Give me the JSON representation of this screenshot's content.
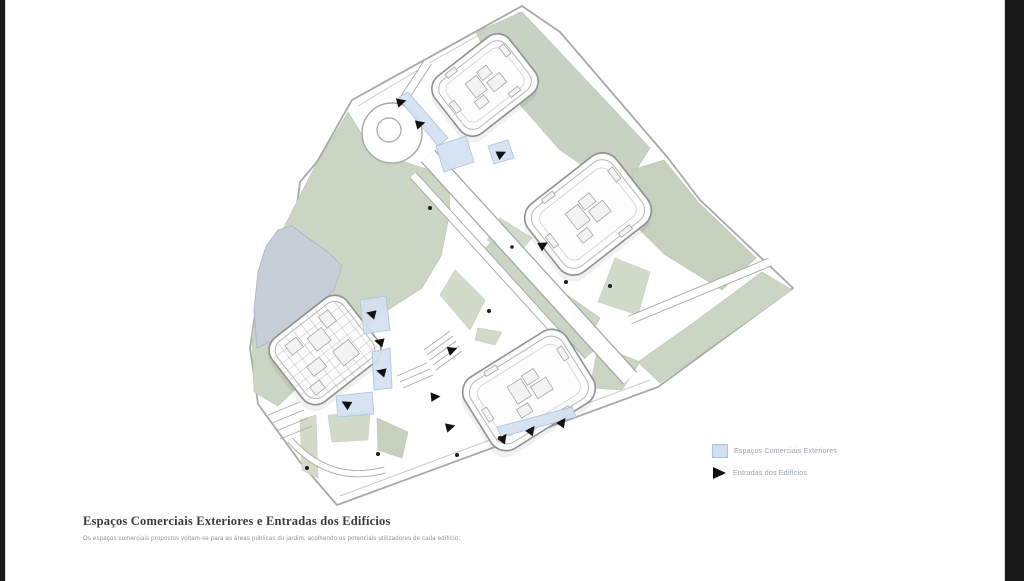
{
  "window": {
    "left_bar_color": "#181818",
    "right_bar_color": "#181818",
    "background": "#ffffff"
  },
  "caption": {
    "title": "Espaços Comerciais Exteriores e Entradas dos Edifícios",
    "subtitle": "Os espaços comerciais propostos voltam-se para as áreas públicas do jardim, acolhendo os potenciais utilizadores de cada edifício."
  },
  "legend": {
    "items": [
      {
        "label": "Espaços Comerciais Exteriores",
        "swatch": "square",
        "fill": "#d2e1f1",
        "border": "#a9c3de"
      },
      {
        "label": "Entradas dos Edifícios",
        "swatch": "triangle",
        "fill": "#111111"
      }
    ]
  },
  "plan": {
    "description": "Axonometric site plan: four rounded courtyard buildings, park with pond, roundabout, diagonal avenue, exterior commercial spaces (blue) and building entrances (black triangles)",
    "buildings_count": 4,
    "colors": {
      "park_green": "#cbd5c3",
      "sage_green": "#c7d2c2",
      "pond_blue": "#c6ced8",
      "commercial_blue": "#d2e1f1",
      "entrance_black": "#111111",
      "outline_gray": "#a5a5a5"
    }
  }
}
